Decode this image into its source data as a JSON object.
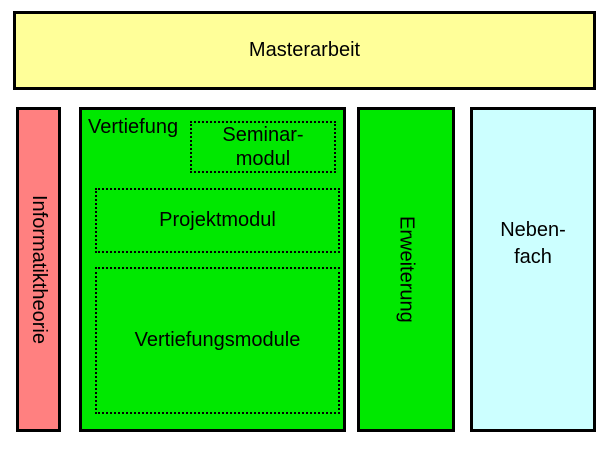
{
  "colors": {
    "masterarbeit_bg": "#FFFF99",
    "informatiktheorie_bg": "#FF8080",
    "vertiefung_bg": "#00E800",
    "erweiterung_bg": "#00E800",
    "nebenfach_bg": "#CCFFFF",
    "border": "#000000",
    "text": "#000000"
  },
  "diagram": {
    "masterarbeit": {
      "label": "Masterarbeit"
    },
    "informatiktheorie": {
      "label": "Informatiktheorie"
    },
    "vertiefung": {
      "label": "Vertiefung",
      "seminarmodul": {
        "line1": "Seminar-",
        "line2": "modul"
      },
      "projektmodul": {
        "label": "Projektmodul"
      },
      "vertiefungsmodule": {
        "label": "Vertiefungsmodule"
      }
    },
    "erweiterung": {
      "label": "Erweiterung"
    },
    "nebenfach": {
      "line1": "Neben-",
      "line2": "fach"
    }
  }
}
